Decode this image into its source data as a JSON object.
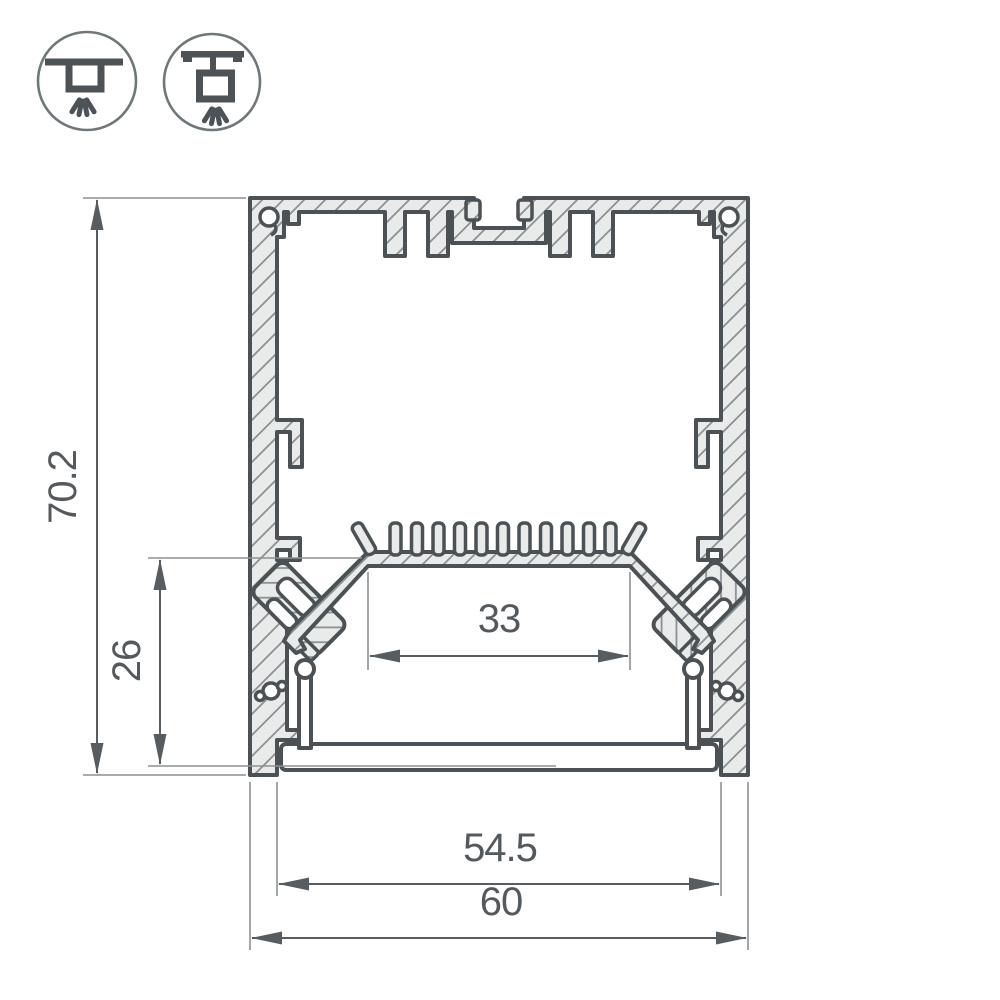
{
  "drawing": {
    "type": "technical-cross-section",
    "subject": "aluminum LED profile cross-section with dimensions",
    "dimensions": {
      "total_height": "70.2",
      "mount_height": "26",
      "led_shelf_width": "33",
      "opening_width": "54.5",
      "total_width": "60"
    },
    "icons": [
      {
        "name": "surface-mounted-luminaire"
      },
      {
        "name": "suspended-luminaire"
      }
    ],
    "colors": {
      "outline": "#4b5155",
      "aluminum_fill": "#e9ebeb",
      "hatch_line": "#8a9093",
      "dimension_line": "#565c60",
      "extension_line": "#8b9194",
      "dimension_text": "#54595d",
      "background": "#ffffff"
    }
  }
}
